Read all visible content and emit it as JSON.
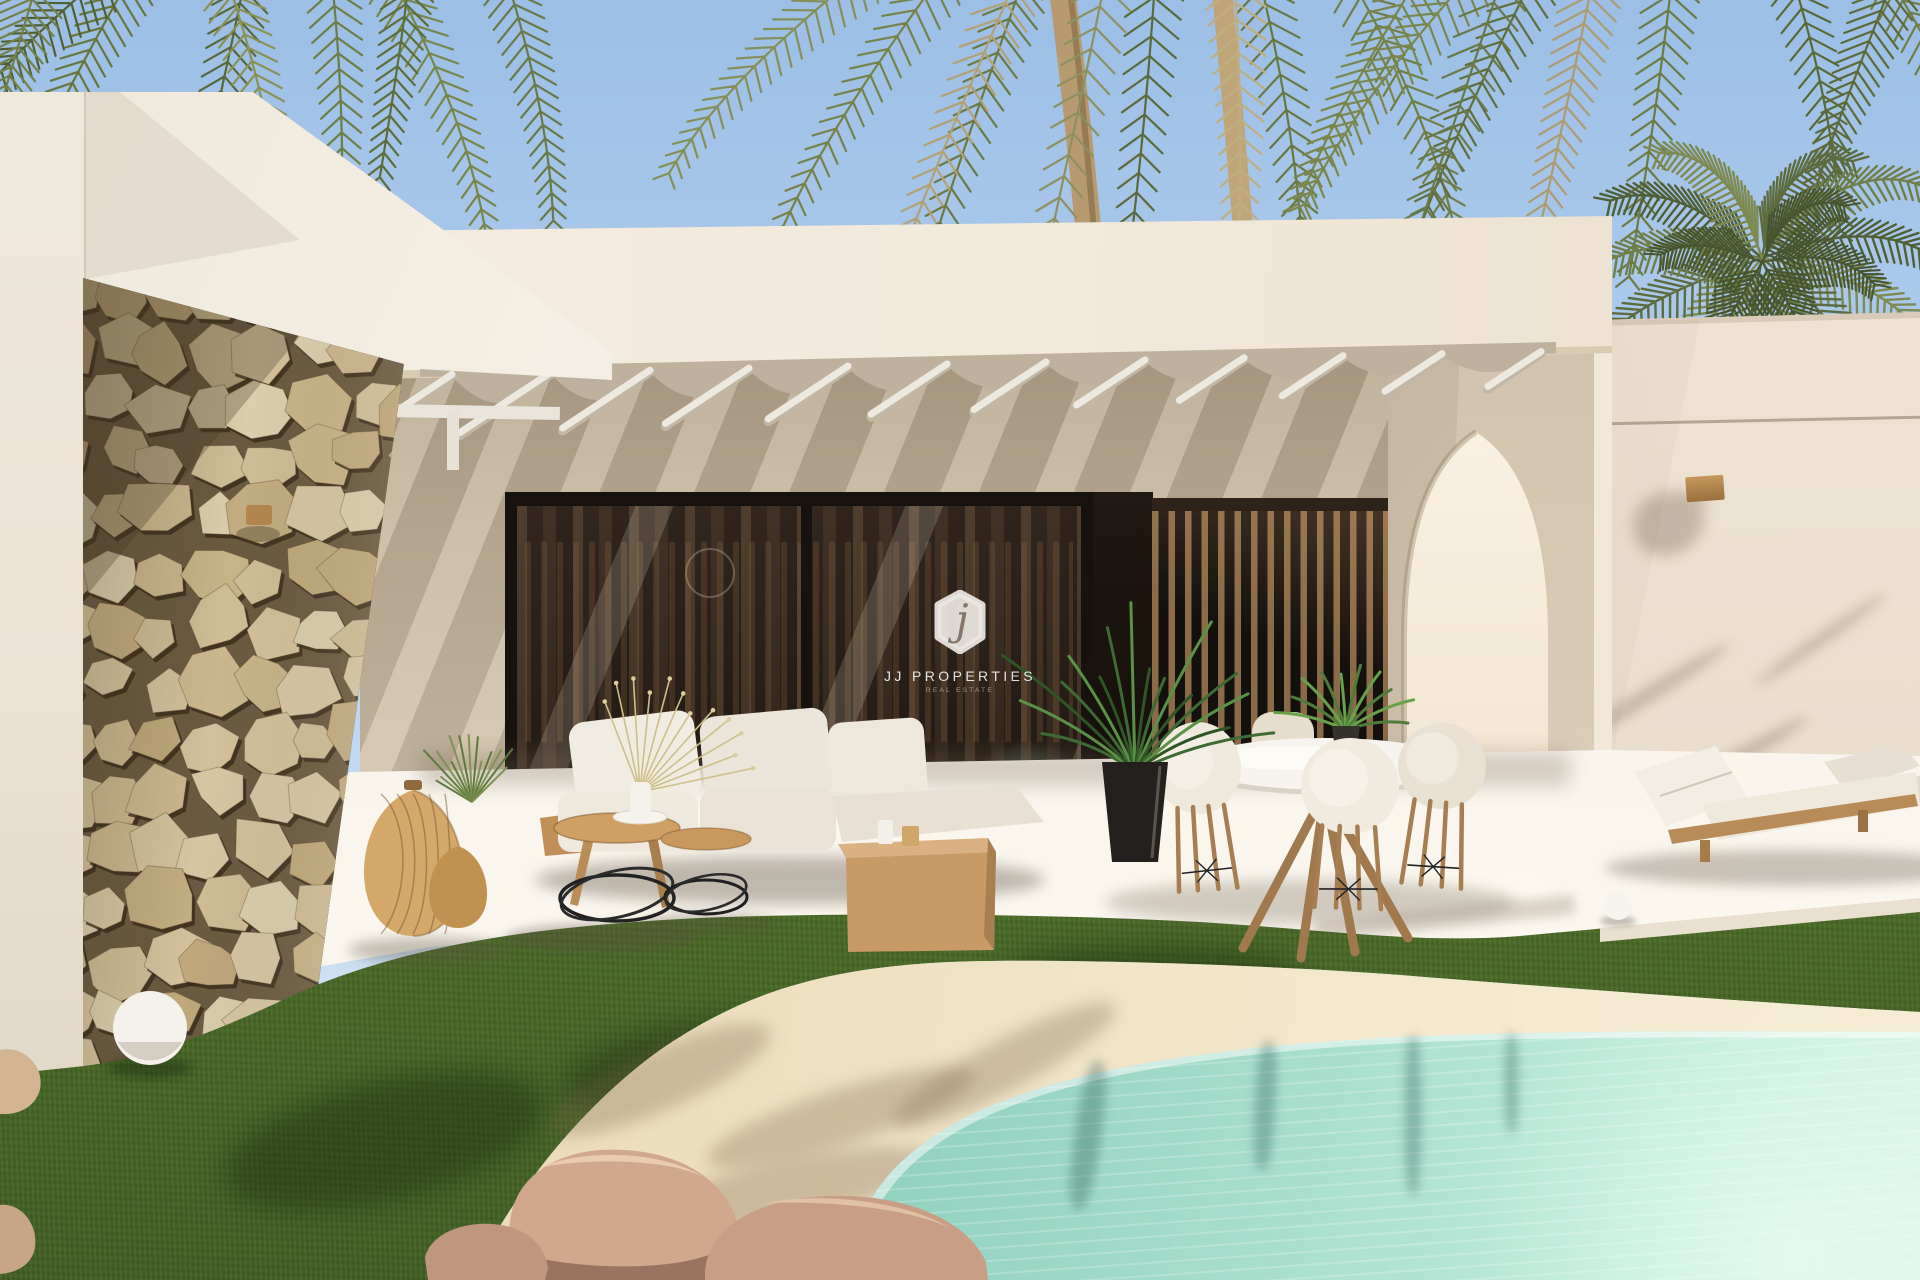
{
  "watermark": {
    "monogram": "j",
    "name": "JJ PROPERTIES",
    "tagline": "REAL ESTATE"
  },
  "palette": {
    "sky_top": "#9dbfe5",
    "sky_bottom": "#cde0f3",
    "wall_cream": "#f2ebdf",
    "wall_shade": "#cdc0ad",
    "stone_tan": "#cfbb96",
    "grass_green": "#5d8132",
    "sand": "#ecdcbc",
    "pool_turquoise": "#8fcfbd",
    "wood": "#b98c5c",
    "glass_dark": "#2e241d",
    "frame_black": "#17120e",
    "palm_green": "#66763f",
    "palm_dry": "#b2a176"
  }
}
